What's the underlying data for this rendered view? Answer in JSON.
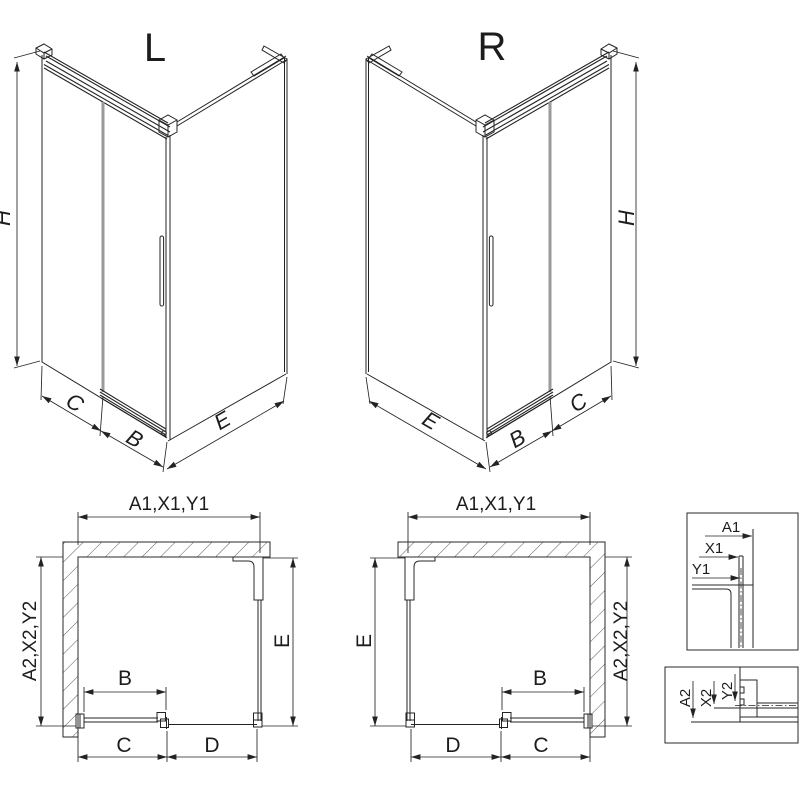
{
  "drawing": {
    "iso_left": {
      "variant": "L",
      "dim_h": "H",
      "dim_c": "C",
      "dim_b": "B",
      "dim_e": "E"
    },
    "iso_right": {
      "variant": "R",
      "dim_h": "H",
      "dim_c": "C",
      "dim_b": "B",
      "dim_e": "E"
    },
    "plan_left": {
      "dim_top": "A1,X1,Y1",
      "dim_left": "A2,X2,Y2",
      "dim_right": "E",
      "dim_door": "B",
      "dim_bottom_left": "C",
      "dim_bottom_right": "D"
    },
    "plan_right": {
      "dim_top": "A1,X1,Y1",
      "dim_right": "A2,X2,Y2",
      "dim_left": "E",
      "dim_door": "B",
      "dim_bottom_left": "D",
      "dim_bottom_right": "C"
    },
    "detail_wall_profile": {
      "dim_a1": "A1",
      "dim_x1": "X1",
      "dim_y1": "Y1"
    },
    "detail_floor_profile": {
      "dim_a2": "A2",
      "dim_x2": "X2",
      "dim_y2": "Y2"
    }
  },
  "colors": {
    "line": "#232323",
    "glass_seam": "#9a9a9a",
    "hatch": "#5a5a5a",
    "background": "#ffffff"
  }
}
